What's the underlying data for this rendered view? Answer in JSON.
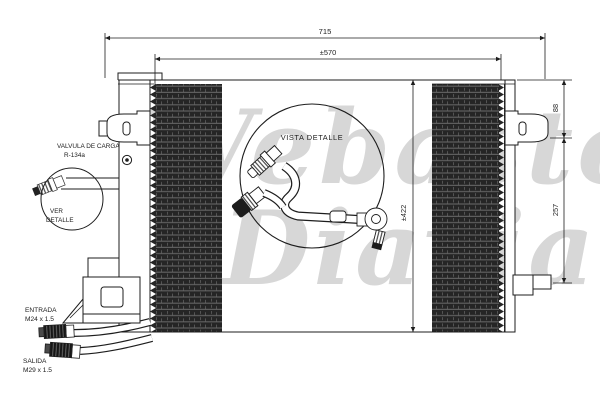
{
  "drawing": {
    "dimensions": {
      "overall_width": "715",
      "core_width": "±570",
      "overall_height": "±422",
      "bracket_top_offset": "88",
      "bracket_span": "257"
    },
    "labels": {
      "charge_valve_line1": "VALVULA DE CARGA",
      "charge_valve_line2": "R-134a",
      "see_detail_line1": "VER",
      "see_detail_line2": "DETALLE",
      "detail_view_title": "VISTA DETALLE",
      "inlet_line1": "ENTRADA",
      "inlet_line2": "M24 x 1.5",
      "outlet_line1": "SALIDA",
      "outlet_line2": "M29 x 1.5"
    },
    "watermark": {
      "line1": "Webasto",
      "line2": "Diavia",
      "color": "#d7d7d7"
    },
    "colors": {
      "line": "#1d1d1d",
      "fin_dark": "#252525",
      "background": "#ffffff"
    }
  }
}
